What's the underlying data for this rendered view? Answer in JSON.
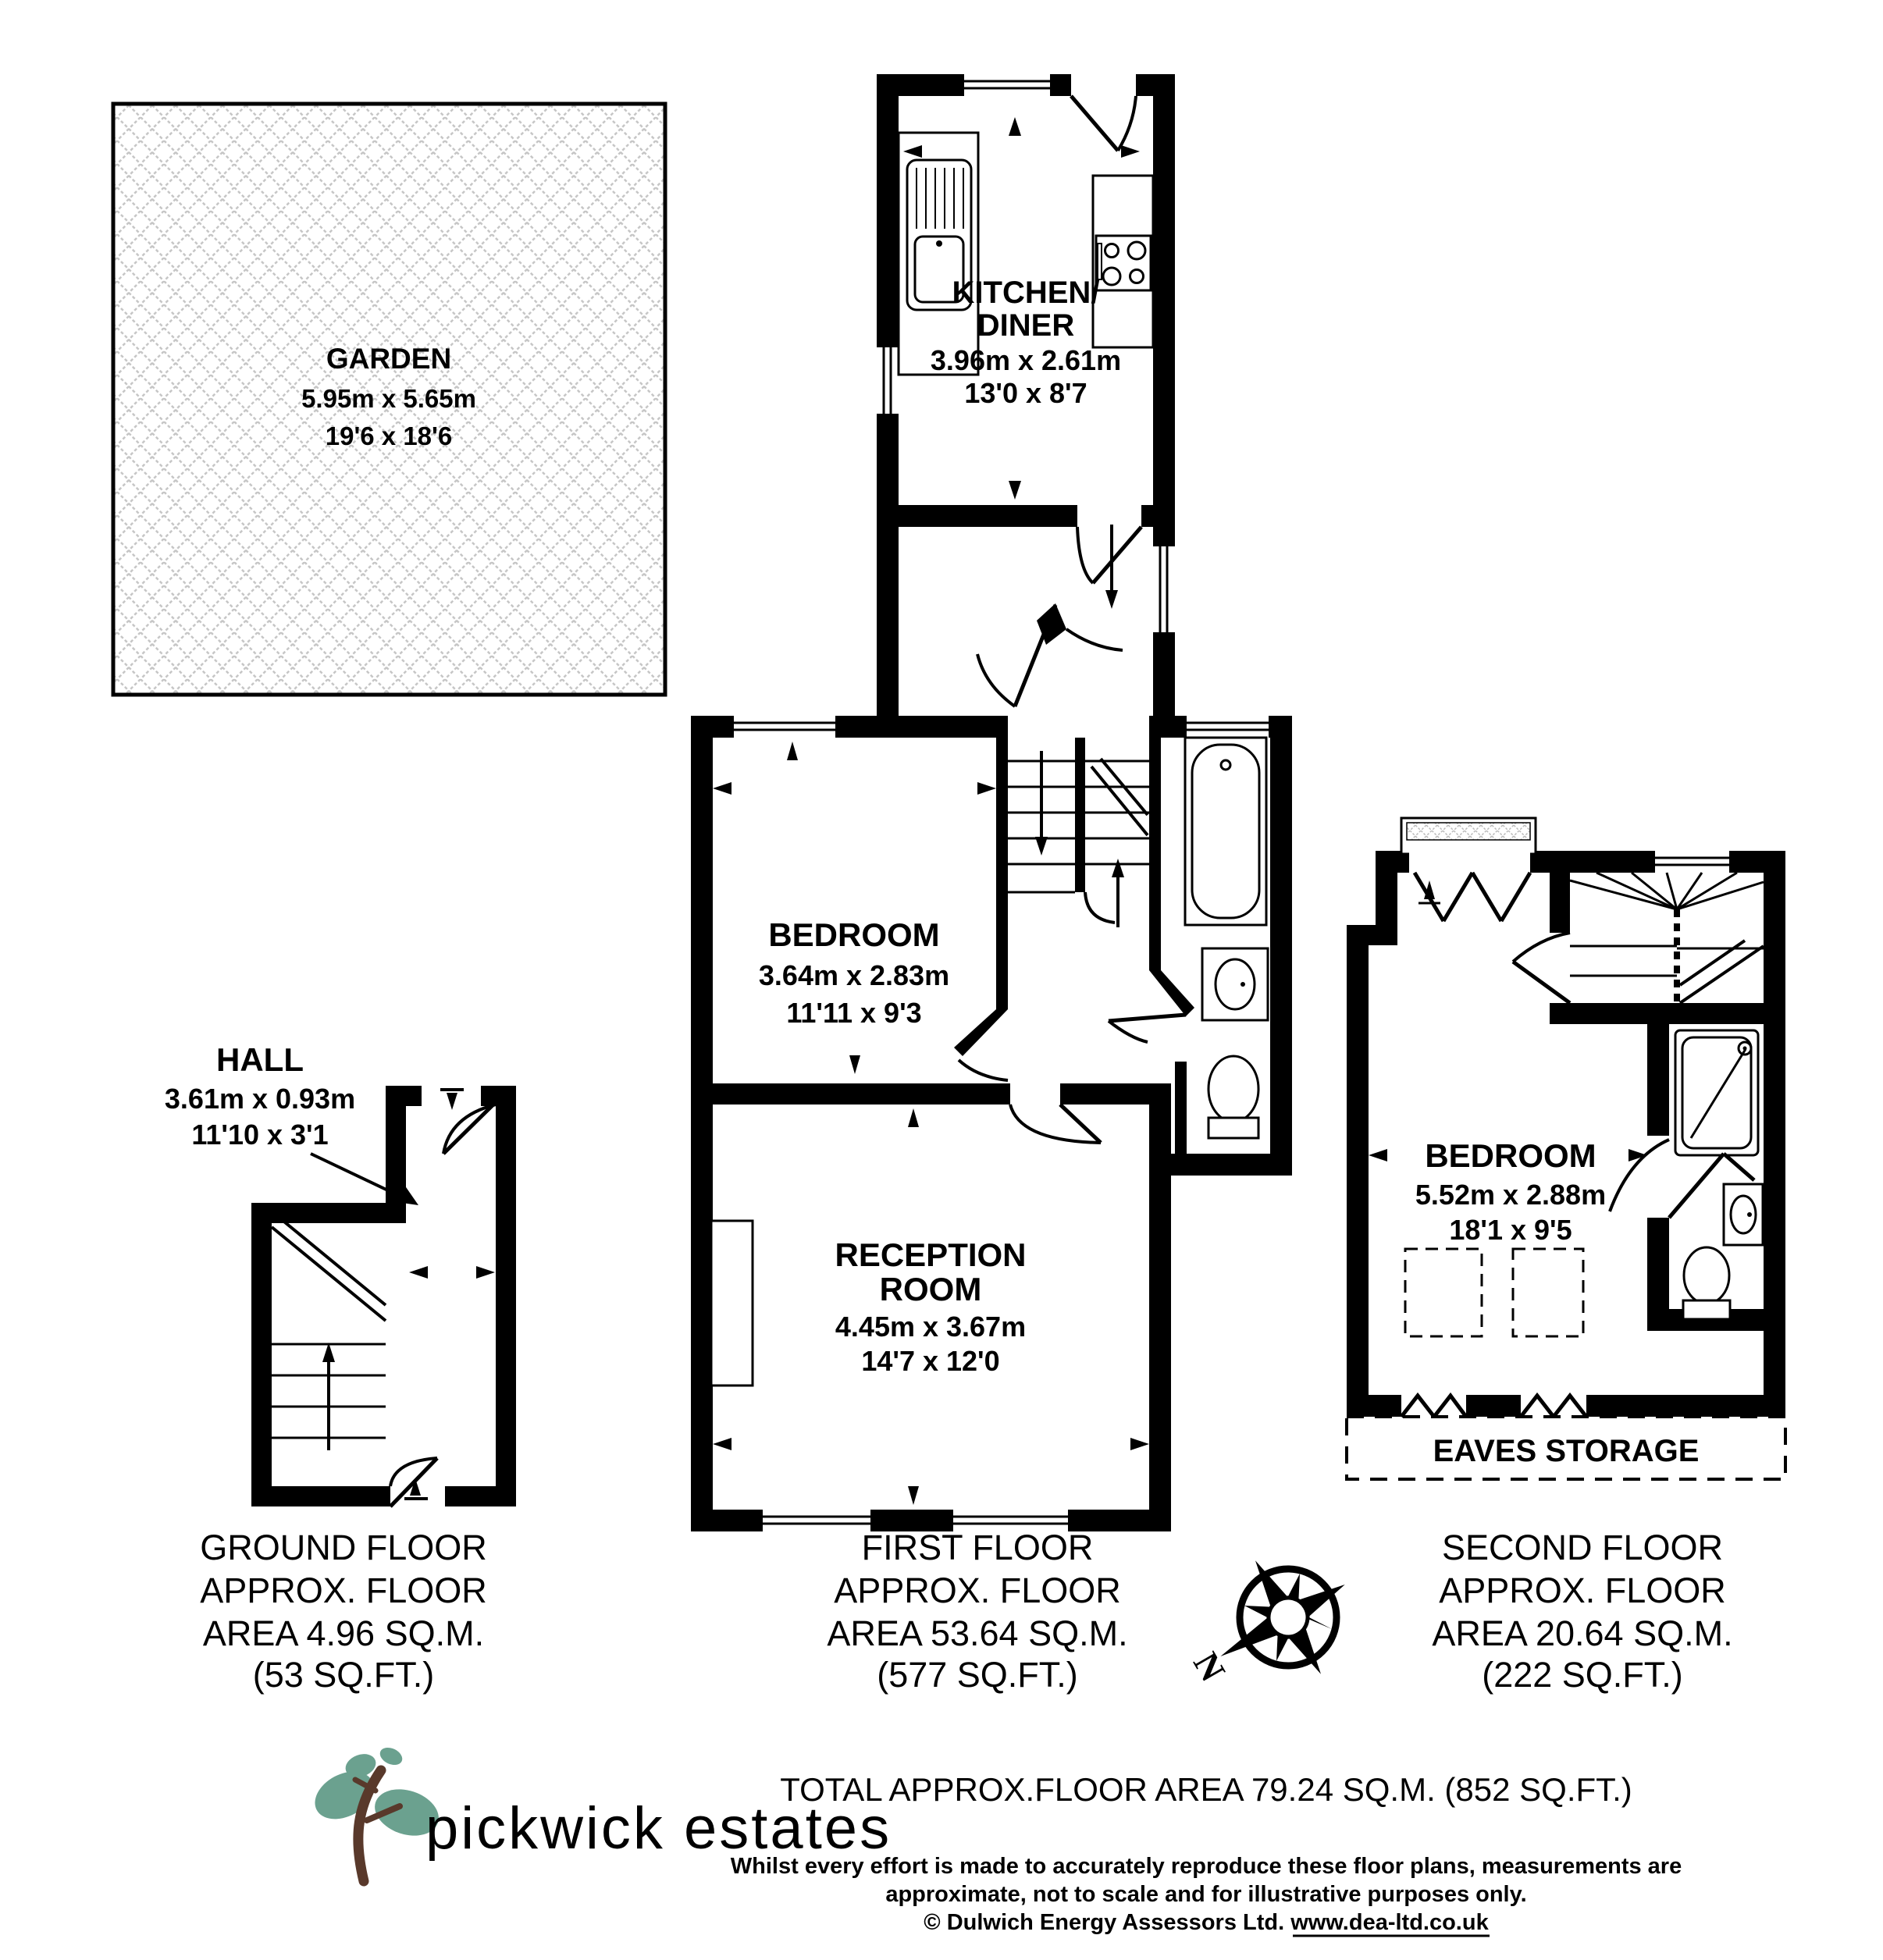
{
  "garden": {
    "title": "GARDEN",
    "metric": "5.95m x 5.65m",
    "imperial": "19'6 x 18'6"
  },
  "ground_floor": {
    "hall": {
      "title": "HALL",
      "metric": "3.61m x 0.93m",
      "imperial": "11'10 x 3'1"
    },
    "label": [
      "GROUND FLOOR",
      "APPROX. FLOOR",
      "AREA 4.96 SQ.M.",
      "(53 SQ.FT.)"
    ]
  },
  "first_floor": {
    "kitchen": {
      "title_line1": "KITCHEN/",
      "title_line2": "DINER",
      "metric": "3.96m x 2.61m",
      "imperial": "13'0 x 8'7"
    },
    "bedroom": {
      "title": "BEDROOM",
      "metric": "3.64m x 2.83m",
      "imperial": "11'11 x 9'3"
    },
    "reception": {
      "title_line1": "RECEPTION",
      "title_line2": "ROOM",
      "metric": "4.45m x 3.67m",
      "imperial": "14'7 x 12'0"
    },
    "label": [
      "FIRST FLOOR",
      "APPROX. FLOOR",
      "AREA 53.64 SQ.M.",
      "(577 SQ.FT.)"
    ]
  },
  "second_floor": {
    "bedroom": {
      "title": "BEDROOM",
      "metric": "5.52m x 2.88m",
      "imperial": "18'1 x 9'5"
    },
    "eaves_label": "EAVES STORAGE",
    "label": [
      "SECOND FLOOR",
      "APPROX. FLOOR",
      "AREA 20.64 SQ.M.",
      "(222 SQ.FT.)"
    ]
  },
  "compass": {
    "north": "N"
  },
  "footer": {
    "logo_text": "pickwick estates",
    "total": "TOTAL APPROX.FLOOR AREA 79.24 SQ.M. (852 SQ.FT.)",
    "disclaimer_line1": "Whilst every effort is made to accurately reproduce these floor plans, measurements are",
    "disclaimer_line2": "approximate, not to scale and for illustrative purposes only.",
    "copyright": "© Dulwich Energy Assessors Ltd. www.dea-ltd.co.uk"
  },
  "colors": {
    "wall": "#000000",
    "hatch": "#c6c6c6",
    "logo_leaf": "#6ba18f",
    "logo_trunk": "#59392b",
    "logo_text": "#4b352e"
  }
}
